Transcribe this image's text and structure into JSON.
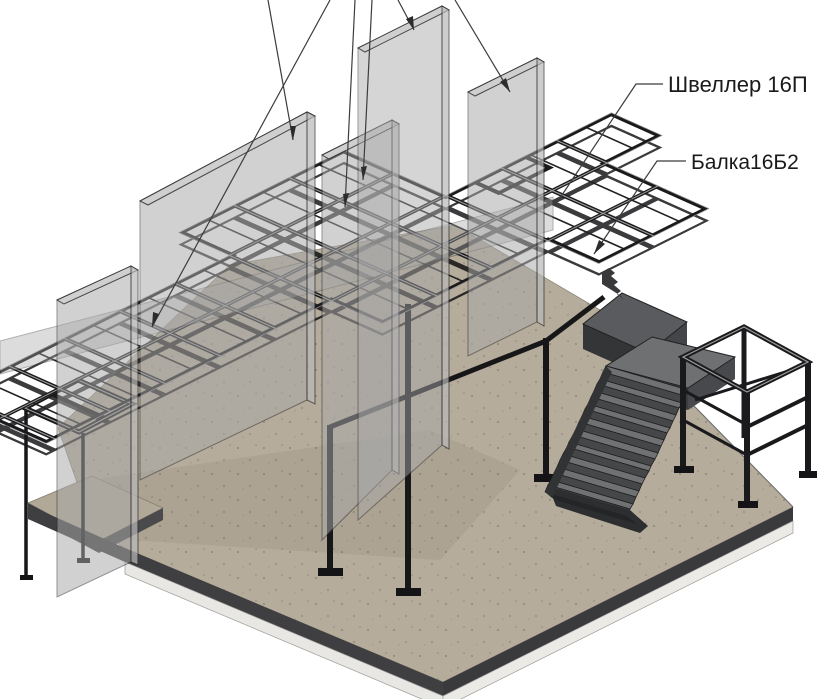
{
  "view": {
    "name": "3d-structural-isometric-view",
    "description": "Isometric CAD view of steel mezzanine frame with concrete walls, ground slab and staircase",
    "background": "#ffffff"
  },
  "labels": {
    "channel": "Швеллер 16П",
    "beam": "Балка16Б2"
  },
  "leaders": [
    {
      "name": "leader-wall-panel-left-far"
    },
    {
      "name": "leader-wall-panel-left"
    },
    {
      "name": "leader-deck-edge-beam"
    },
    {
      "name": "leader-wall-panel-middle-low"
    },
    {
      "name": "leader-wall-panel-middle-top"
    },
    {
      "name": "leader-wall-panel-right"
    },
    {
      "name": "leader-channel-16p"
    },
    {
      "name": "leader-beam-16b2"
    }
  ],
  "colors": {
    "floor": "#b6ac9b",
    "floor_edge": "#3f3f41",
    "slab_apron": "#e9e7e3",
    "wall": "#a8a8a8",
    "wall_top": "#cfcfcf",
    "steel": "#1a1a1c",
    "steel_highlight": "#9c9c9c",
    "stair_top": "#6f7173",
    "stair_riser": "#454749",
    "landing": "#595b5e",
    "platform": "#6e7072",
    "leader_line": "#3c3c3c"
  }
}
